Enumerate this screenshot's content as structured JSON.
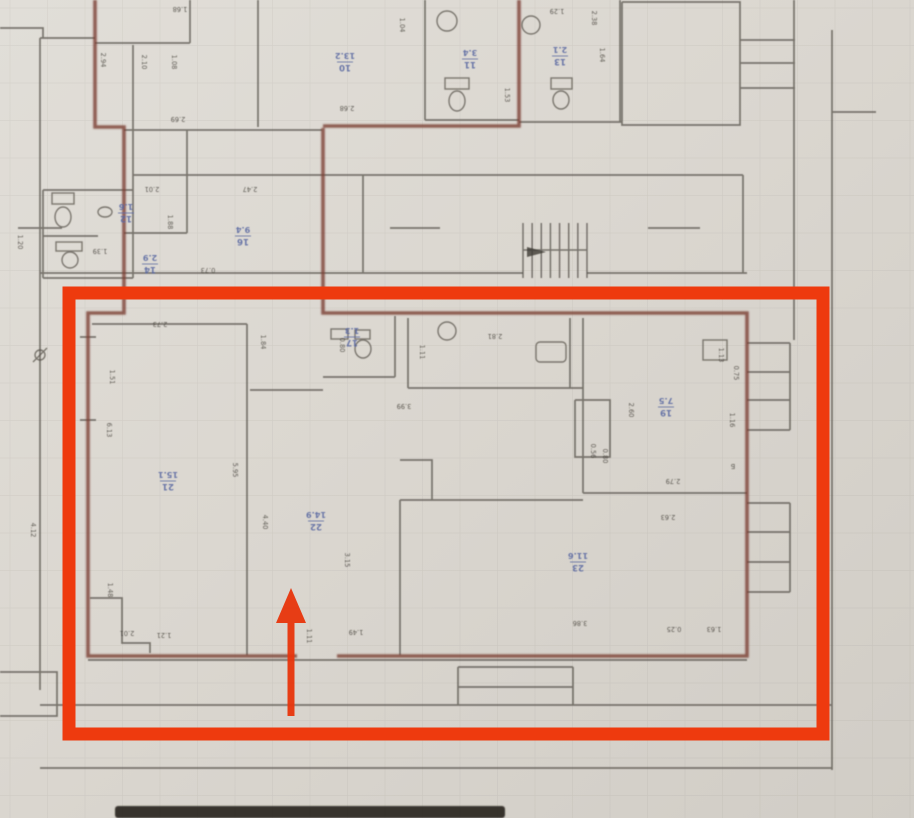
{
  "document": {
    "type": "photographed BTI floor plan with highlighted apartment",
    "orientation_note": "plan text appears rotated 180 degrees (sheet photographed upside down)"
  },
  "colors": {
    "paper": "#dcd8d1",
    "walls": "#55514a",
    "apartment_boundary_maroon": "#7b4136",
    "room_label_blue": "#5565a0",
    "dimension_text": "#44403a",
    "highlight_red": "#ee3a0e"
  },
  "annotations": {
    "highlight_rectangle": "red box around ground-floor apartment",
    "entrance_arrow_direction": "up (into apartment entrance)"
  },
  "room_labels": [
    {
      "num": "21",
      "area": "15.1",
      "x": 168,
      "y": 482
    },
    {
      "num": "22",
      "area": "14.9",
      "x": 316,
      "y": 522
    },
    {
      "num": "17",
      "area": "1.3",
      "x": 352,
      "y": 338
    },
    {
      "num": "19",
      "area": "7.5",
      "x": 666,
      "y": 408
    },
    {
      "num": "23",
      "area": "11.6",
      "x": 578,
      "y": 563
    },
    {
      "num": "10",
      "area": "13.2",
      "x": 345,
      "y": 63
    },
    {
      "num": "11",
      "area": "3.4",
      "x": 470,
      "y": 60
    },
    {
      "num": "13",
      "area": "2.1",
      "x": 560,
      "y": 57
    },
    {
      "num": "16",
      "area": "9.4",
      "x": 243,
      "y": 237
    },
    {
      "num": "12",
      "area": "1.6",
      "x": 126,
      "y": 214
    },
    {
      "num": "14",
      "area": "2.9",
      "x": 150,
      "y": 265
    }
  ],
  "dimensions": [
    {
      "t": "2.94",
      "x": 101,
      "y": 60,
      "r": 90
    },
    {
      "t": "2.10",
      "x": 142,
      "y": 62,
      "r": 90
    },
    {
      "t": "1.08",
      "x": 172,
      "y": 62,
      "r": 90
    },
    {
      "t": "1.68",
      "x": 180,
      "y": 7,
      "r": 180
    },
    {
      "t": "2.69",
      "x": 178,
      "y": 117,
      "r": 180
    },
    {
      "t": "1.04",
      "x": 400,
      "y": 25,
      "r": 90
    },
    {
      "t": "2.68",
      "x": 347,
      "y": 106,
      "r": 180
    },
    {
      "t": "1.53",
      "x": 505,
      "y": 95,
      "r": 90
    },
    {
      "t": "2.38",
      "x": 592,
      "y": 18,
      "r": 90
    },
    {
      "t": "1.29",
      "x": 557,
      "y": 9,
      "r": 180
    },
    {
      "t": "1.64",
      "x": 600,
      "y": 55,
      "r": 90
    },
    {
      "t": "2.01",
      "x": 152,
      "y": 187,
      "r": 180
    },
    {
      "t": "2.47",
      "x": 250,
      "y": 187,
      "r": 180
    },
    {
      "t": "1.88",
      "x": 168,
      "y": 222,
      "r": 90
    },
    {
      "t": "0.73",
      "x": 208,
      "y": 268,
      "r": 180
    },
    {
      "t": "1.20",
      "x": 18,
      "y": 242,
      "r": 90
    },
    {
      "t": "1.39",
      "x": 100,
      "y": 249,
      "r": 180
    },
    {
      "t": "2.73",
      "x": 160,
      "y": 322,
      "r": 180
    },
    {
      "t": "1.84",
      "x": 261,
      "y": 342,
      "r": 90
    },
    {
      "t": "1.51",
      "x": 110,
      "y": 377,
      "r": 90
    },
    {
      "t": "6.13",
      "x": 107,
      "y": 430,
      "r": 90
    },
    {
      "t": "5.95",
      "x": 233,
      "y": 470,
      "r": 90
    },
    {
      "t": "4.40",
      "x": 263,
      "y": 522,
      "r": 90
    },
    {
      "t": "3.15",
      "x": 345,
      "y": 560,
      "r": 90
    },
    {
      "t": "0.80",
      "x": 340,
      "y": 345,
      "r": 90
    },
    {
      "t": "1.11",
      "x": 420,
      "y": 352,
      "r": 90
    },
    {
      "t": "2.81",
      "x": 495,
      "y": 334,
      "r": 180
    },
    {
      "t": "3.99",
      "x": 404,
      "y": 404,
      "r": 180
    },
    {
      "t": "2.60",
      "x": 629,
      "y": 410,
      "r": 90
    },
    {
      "t": "2.79",
      "x": 673,
      "y": 479,
      "r": 180
    },
    {
      "t": "0.56",
      "x": 591,
      "y": 451,
      "r": 90
    },
    {
      "t": "0.80",
      "x": 603,
      "y": 456,
      "r": 90
    },
    {
      "t": "1.13",
      "x": 719,
      "y": 355,
      "r": 90
    },
    {
      "t": "0.75",
      "x": 734,
      "y": 373,
      "r": 90
    },
    {
      "t": "1.16",
      "x": 730,
      "y": 420,
      "r": 90
    },
    {
      "t": "Б",
      "x": 733,
      "y": 464,
      "r": 180
    },
    {
      "t": "2.63",
      "x": 668,
      "y": 515,
      "r": 180
    },
    {
      "t": "3.86",
      "x": 580,
      "y": 621,
      "r": 180
    },
    {
      "t": "0.25",
      "x": 674,
      "y": 627,
      "r": 180
    },
    {
      "t": "1.63",
      "x": 714,
      "y": 627,
      "r": 180
    },
    {
      "t": "2.01",
      "x": 127,
      "y": 631,
      "r": 180
    },
    {
      "t": "1.21",
      "x": 164,
      "y": 633,
      "r": 180
    },
    {
      "t": "1.48",
      "x": 108,
      "y": 590,
      "r": 90
    },
    {
      "t": "1.49",
      "x": 356,
      "y": 630,
      "r": 180
    },
    {
      "t": "1.11",
      "x": 307,
      "y": 636,
      "r": 90
    },
    {
      "t": "4.12",
      "x": 31,
      "y": 530,
      "r": 90
    }
  ]
}
